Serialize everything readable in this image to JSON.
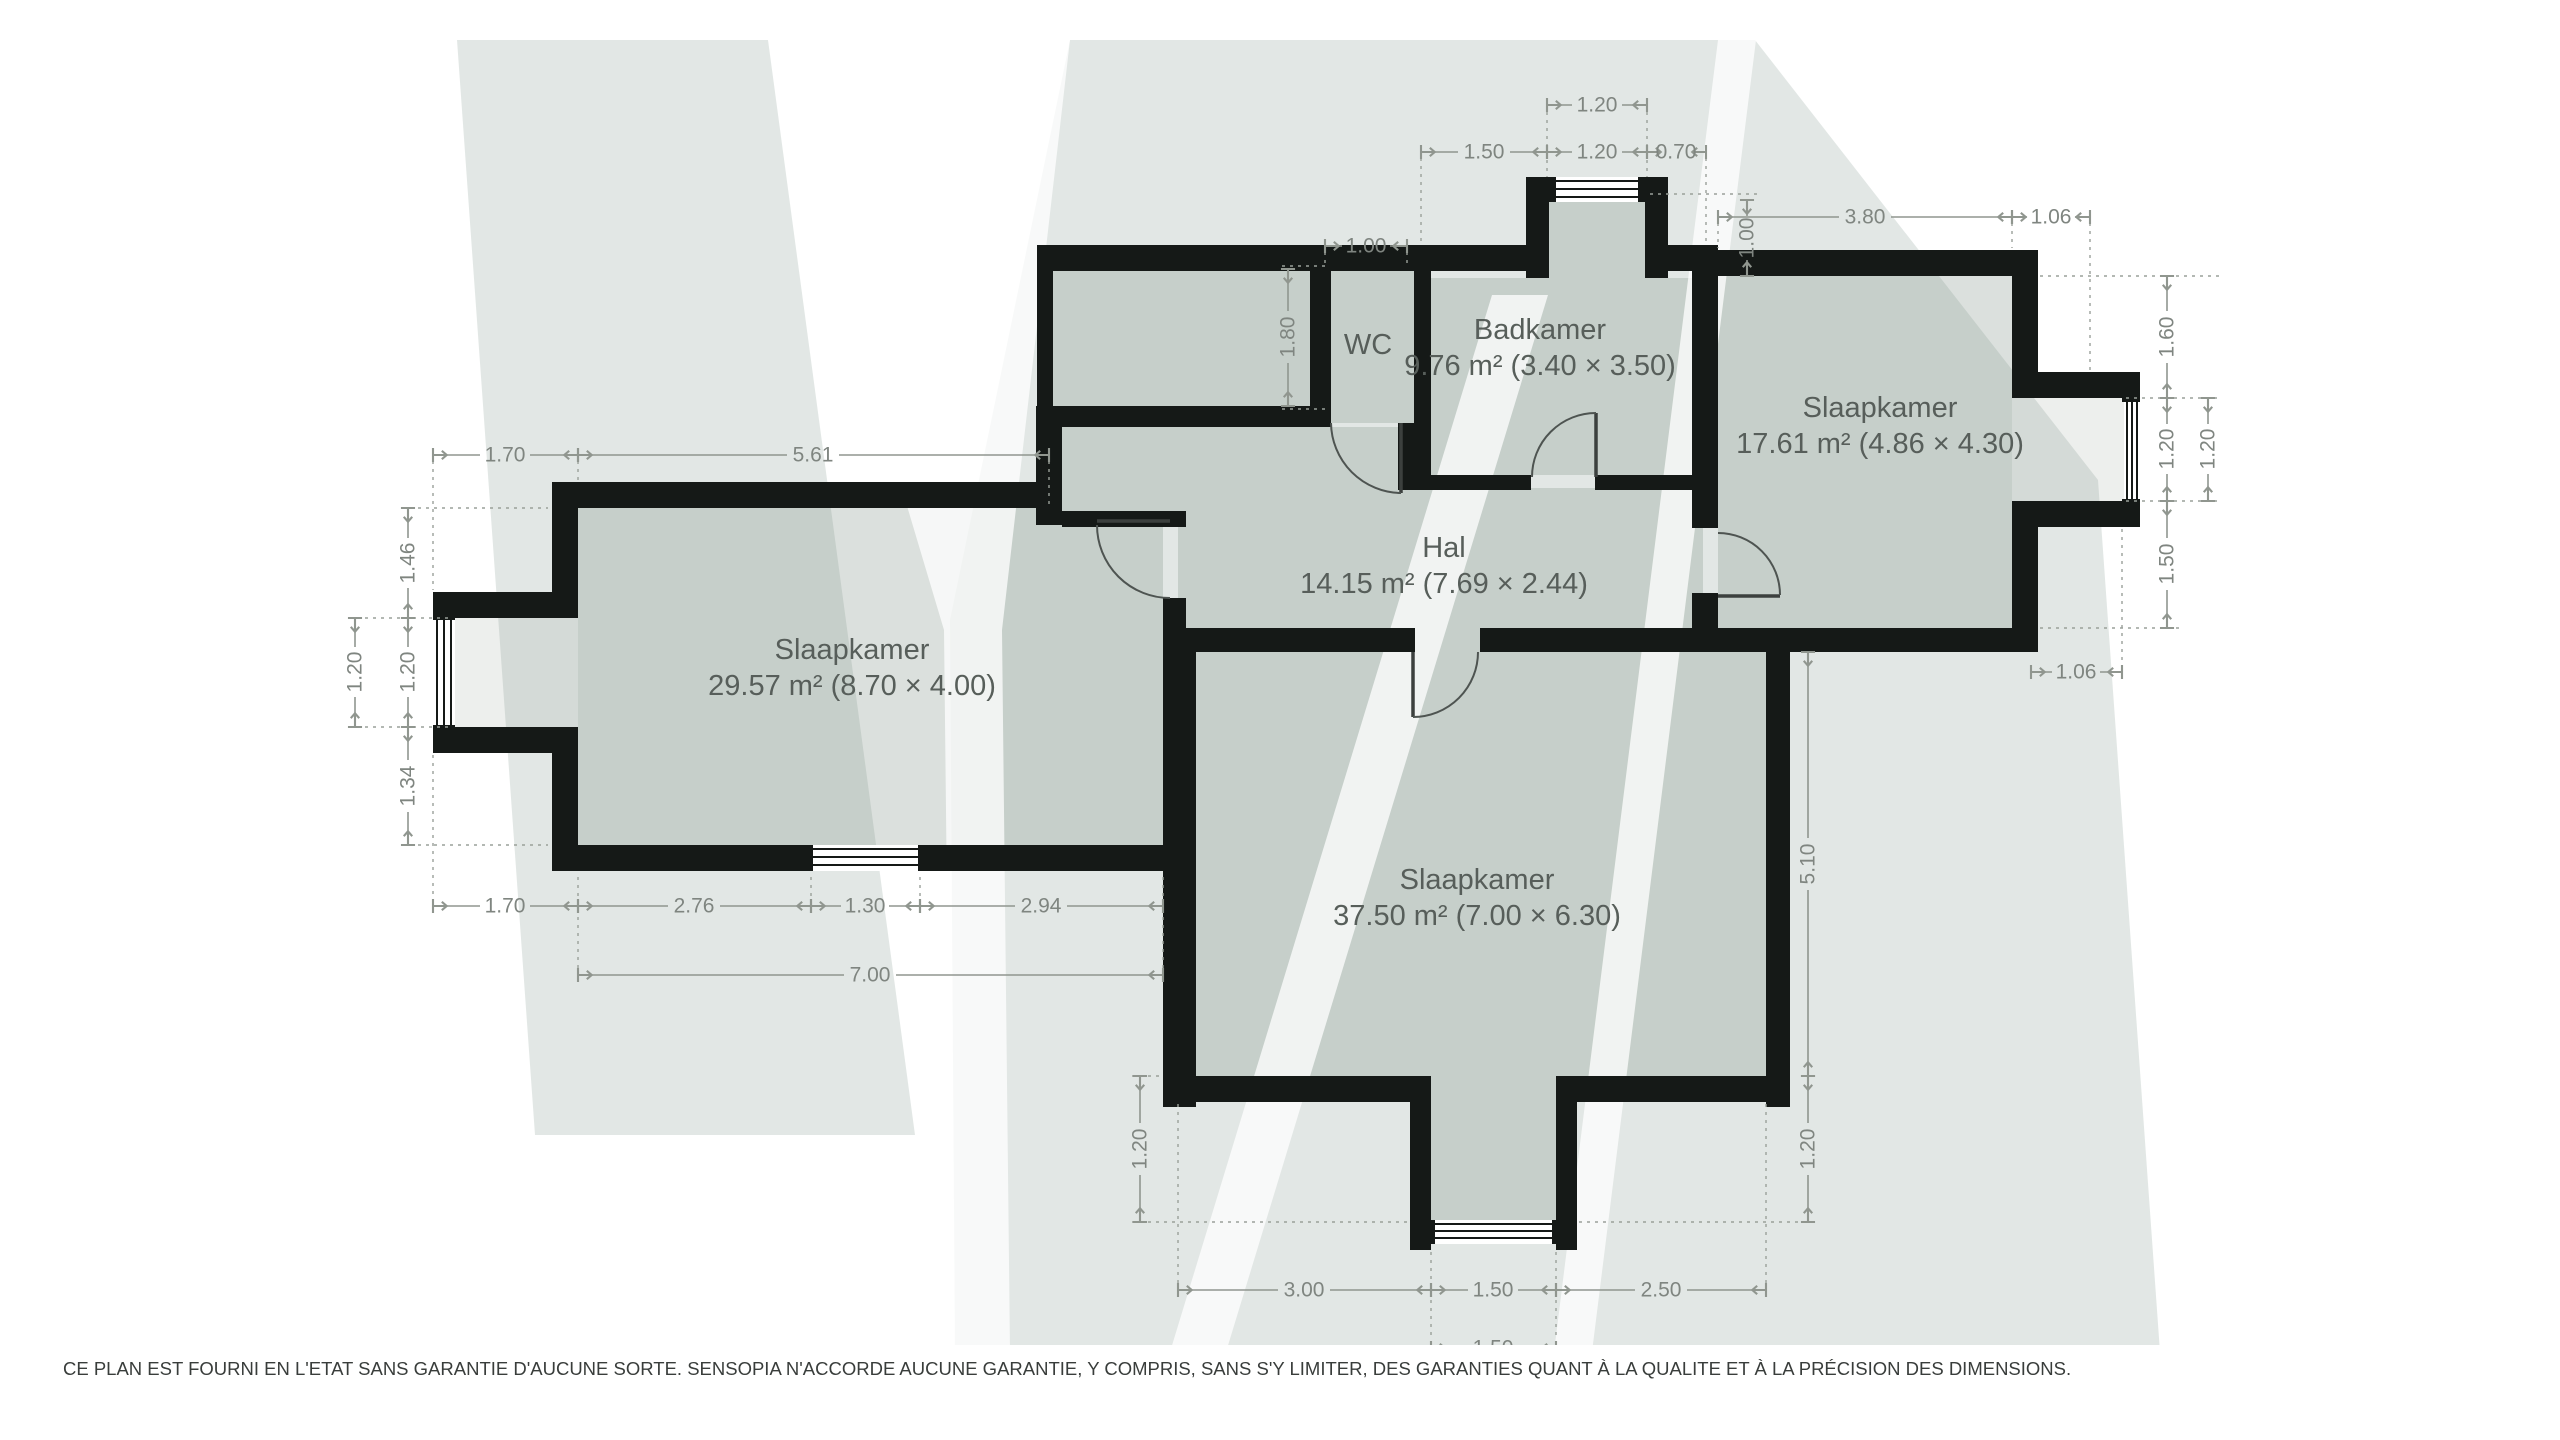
{
  "rooms": {
    "slaapkamer_left": {
      "name": "Slaapkamer",
      "area": "29.57 m² (8.70 × 4.00)"
    },
    "wc": {
      "name": "WC"
    },
    "badkamer": {
      "name": "Badkamer",
      "area": "9.76 m² (3.40 × 3.50)"
    },
    "slaapkamer_right": {
      "name": "Slaapkamer",
      "area": "17.61 m² (4.86 × 4.30)"
    },
    "hal": {
      "name": "Hal",
      "area": "14.15 m² (7.69 × 2.44)"
    },
    "slaapkamer_bottom": {
      "name": "Slaapkamer",
      "area": "37.50 m² (7.00 × 6.30)"
    }
  },
  "dimensions": {
    "d1": "1.20",
    "d2": "1.50",
    "d3": "1.20",
    "d4": "0.70",
    "d5": "1.00",
    "d6": "1.00",
    "d7": "3.80",
    "d8": "1.06",
    "d9": "1.60",
    "d10": "1.20",
    "d11": "1.20",
    "d12": "1.50",
    "d13": "1.06",
    "d14": "1.70",
    "d15": "5.61",
    "d16": "1.46",
    "d17": "1.20",
    "d18": "1.34",
    "d19": "1.20",
    "d20": "1.70",
    "d21": "2.76",
    "d22": "1.30",
    "d23": "2.94",
    "d24": "7.00",
    "d25": "1.80",
    "d26": "5.10",
    "d27": "1.20",
    "d28": "1.20",
    "d29": "3.00",
    "d30": "1.50",
    "d31": "2.50",
    "d32": "1.50"
  },
  "disclaimer": "CE PLAN EST FOURNI EN L'ETAT SANS GARANTIE D'AUCUNE SORTE. SENSOPIA N'ACCORDE AUCUNE GARANTIE, Y COMPRIS, SANS S'Y LIMITER, DES GARANTIES QUANT À LA QUALITE ET À LA PRÉCISION DES DIMENSIONS.",
  "colors": {
    "wall": "#151917",
    "floor": "#dbe0dd",
    "bay_floor": "#edefed",
    "watermark": "#7c9288",
    "dimension": "#90968f",
    "label": "#575e5a",
    "disclaimer": "#393d3b",
    "background": "#ffffff"
  }
}
